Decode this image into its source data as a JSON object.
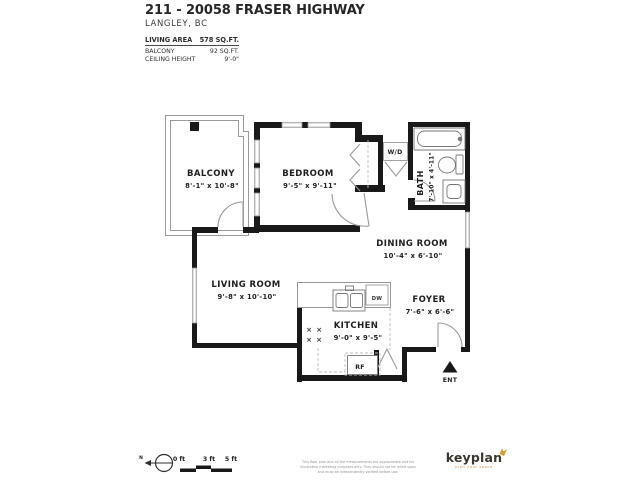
{
  "header": {
    "title": "211 - 20058 FRASER HIGHWAY",
    "subtitle": "LANGLEY, BC"
  },
  "stats": {
    "rows": [
      {
        "label": "LIVING AREA",
        "value": "578 SQ.FT."
      },
      {
        "label": "BALCONY",
        "value": "92 SQ.FT."
      },
      {
        "label": "CEILING HEIGHT",
        "value": "9'-0\""
      }
    ]
  },
  "rooms": {
    "balcony": {
      "name": "BALCONY",
      "dims": "8'-1\" x 10'-8\""
    },
    "bedroom": {
      "name": "BEDROOM",
      "dims": "9'-5\" x 9'-11\""
    },
    "bath": {
      "name": "BATH",
      "dims": "7'-10\" x 4'-11\""
    },
    "dining": {
      "name": "DINING ROOM",
      "dims": "10'-4\" x 6'-10\""
    },
    "living": {
      "name": "LIVING ROOM",
      "dims": "9'-8\" x 10'-10\""
    },
    "kitchen": {
      "name": "KITCHEN",
      "dims": "9'-0\" x 9'-5\""
    },
    "foyer": {
      "name": "FOYER",
      "dims": "7'-6\" x 6'-6\""
    }
  },
  "fixtures": {
    "washer_dryer": "W/D",
    "dishwasher": "DW",
    "refrigerator": "RF",
    "burner": "×"
  },
  "entry": {
    "label": "ENT"
  },
  "scale_bar": {
    "north": "N",
    "ticks": [
      "0 ft",
      "3 ft",
      "5 ft"
    ]
  },
  "footer": {
    "disclaimer": "This floor plan and all the measurements are approximate and for illustrative marketing purposes only. They should not be relied upon and must be independently verified before use."
  },
  "brand": {
    "logo": "keyplan",
    "tagline": "plan your space"
  },
  "colors": {
    "wall": "#191919",
    "thin_line": "#8c8c8c",
    "accent_orange": "#d8992e",
    "text": "#222222"
  }
}
